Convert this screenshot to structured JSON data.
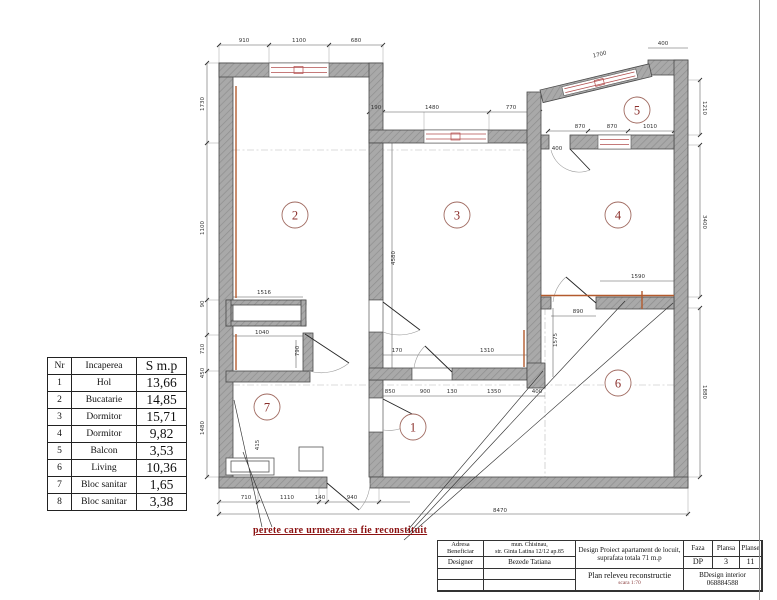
{
  "colors": {
    "accent_red": "#8b1111",
    "wall_gray": "#a9a9a9",
    "reconstruct_orange": "#b35a2d",
    "marker_red": "#8b2f2b"
  },
  "note": {
    "text": "perete care urmeaza sa fie reconstituit"
  },
  "rooms_table": {
    "headers": [
      "Nr",
      "Incaperea",
      "S m.p"
    ],
    "rows": [
      {
        "nr": "1",
        "name": "Hol",
        "area": "13,66"
      },
      {
        "nr": "2",
        "name": "Bucatarie",
        "area": "14,85"
      },
      {
        "nr": "3",
        "name": "Dormitor",
        "area": "15,71"
      },
      {
        "nr": "4",
        "name": "Dormitor",
        "area": "9,82"
      },
      {
        "nr": "5",
        "name": "Balcon",
        "area": "3,53"
      },
      {
        "nr": "6",
        "name": "Living",
        "area": "10,36"
      },
      {
        "nr": "7",
        "name": "Bloc sanitar",
        "area": "1,65"
      },
      {
        "nr": "8",
        "name": "Bloc sanitar",
        "area": "3,38"
      }
    ]
  },
  "title_block": {
    "adresa_label": "Adresa",
    "beneficiar_label": "Beneficiar",
    "designer_label": "Designer",
    "address_line1": "mun. Chisinau,",
    "address_line2": "str. Ginta Latina 12/12 ap.85",
    "designer_name": "Bezede Tatiana",
    "project_line1": "Design Proiect apartament de locuit,",
    "project_line2": "suprafata totala 71 m.p",
    "drawing_title": "Plan releveu reconstructie",
    "scale": "scara 1:70",
    "faza_label": "Faza",
    "plansa_label": "Plansa",
    "planse_label": "Planse",
    "faza_value": "DP",
    "plansa_value": "3",
    "planse_value": "11",
    "studio_line1": "BDesign interior",
    "studio_line2": "068884588"
  },
  "plan": {
    "room_markers": [
      {
        "n": "1",
        "x": 413,
        "y": 427
      },
      {
        "n": "2",
        "x": 295,
        "y": 215
      },
      {
        "n": "3",
        "x": 457,
        "y": 215
      },
      {
        "n": "4",
        "x": 618,
        "y": 215
      },
      {
        "n": "5",
        "x": 637,
        "y": 110
      },
      {
        "n": "6",
        "x": 618,
        "y": 383
      },
      {
        "n": "7",
        "x": 267,
        "y": 407
      }
    ],
    "dims": [
      {
        "t": "910",
        "x": 244,
        "y": 42
      },
      {
        "t": "1100",
        "x": 299,
        "y": 42
      },
      {
        "t": "680",
        "x": 356,
        "y": 42
      },
      {
        "t": "190",
        "x": 376,
        "y": 109
      },
      {
        "t": "1480",
        "x": 432,
        "y": 109
      },
      {
        "t": "770",
        "x": 511,
        "y": 109
      },
      {
        "t": "870",
        "x": 580,
        "y": 128
      },
      {
        "t": "870",
        "x": 612,
        "y": 128
      },
      {
        "t": "1010",
        "x": 650,
        "y": 128
      },
      {
        "t": "400",
        "x": 663,
        "y": 45
      },
      {
        "t": "1700",
        "x": 600,
        "y": 56,
        "r": -13.5
      },
      {
        "t": "1210",
        "x": 703,
        "y": 108,
        "r": 90
      },
      {
        "t": "3400",
        "x": 703,
        "y": 222,
        "r": 90
      },
      {
        "t": "1880",
        "x": 703,
        "y": 392,
        "r": 90
      },
      {
        "t": "1730",
        "x": 204,
        "y": 104,
        "r": -90
      },
      {
        "t": "1100",
        "x": 204,
        "y": 228,
        "r": -90
      },
      {
        "t": "90",
        "x": 204,
        "y": 304,
        "r": -90
      },
      {
        "t": "710",
        "x": 204,
        "y": 349,
        "r": -90
      },
      {
        "t": "450",
        "x": 204,
        "y": 373,
        "r": -90
      },
      {
        "t": "1480",
        "x": 204,
        "y": 428,
        "r": -90
      },
      {
        "t": "710",
        "x": 246,
        "y": 499
      },
      {
        "t": "1110",
        "x": 287,
        "y": 499
      },
      {
        "t": "140",
        "x": 320,
        "y": 499
      },
      {
        "t": "940",
        "x": 352,
        "y": 499
      },
      {
        "t": "8470",
        "x": 500,
        "y": 512
      },
      {
        "t": "1516",
        "x": 264,
        "y": 294
      },
      {
        "t": "1040",
        "x": 262,
        "y": 334
      },
      {
        "t": "790",
        "x": 299,
        "y": 351,
        "r": -90
      },
      {
        "t": "170",
        "x": 397,
        "y": 352
      },
      {
        "t": "1310",
        "x": 487,
        "y": 352
      },
      {
        "t": "850",
        "x": 390,
        "y": 393
      },
      {
        "t": "900",
        "x": 425,
        "y": 393
      },
      {
        "t": "130",
        "x": 452,
        "y": 393
      },
      {
        "t": "1350",
        "x": 494,
        "y": 393
      },
      {
        "t": "400",
        "x": 537,
        "y": 393
      },
      {
        "t": "890",
        "x": 578,
        "y": 313
      },
      {
        "t": "1590",
        "x": 638,
        "y": 278
      },
      {
        "t": "1575",
        "x": 557,
        "y": 340,
        "r": -90
      },
      {
        "t": "4580",
        "x": 395,
        "y": 258,
        "r": -90
      },
      {
        "t": "400",
        "x": 557,
        "y": 150
      },
      {
        "t": "415",
        "x": 259,
        "y": 445,
        "r": -90
      }
    ]
  }
}
